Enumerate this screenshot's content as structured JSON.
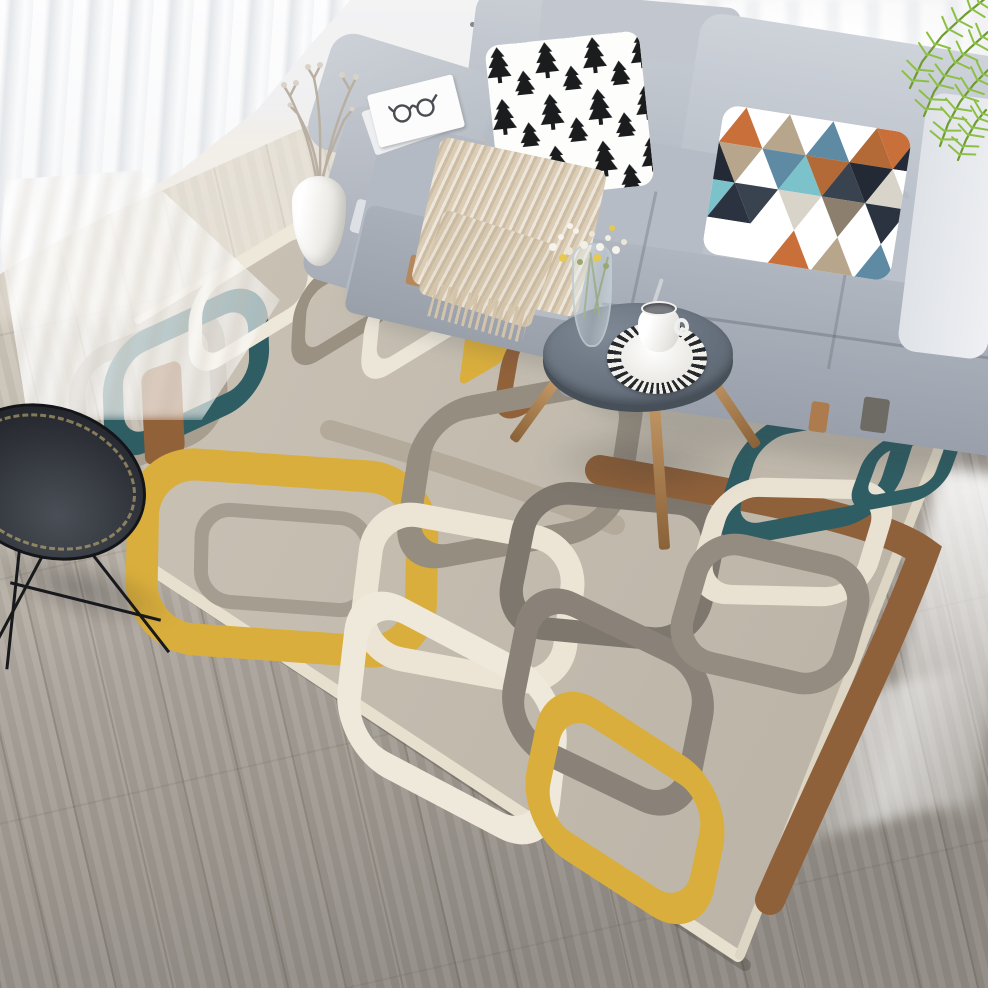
{
  "meta": {
    "title": "Scandinavian living room with geometric area rug",
    "description": "Photograph of a bright living room: gray sectional sofa with a black-and-white pine-tree pillow and a multicolor triangle pillow, beige knitted throw, white sheer curtain, gray wood plank floor, small round gray coffee table with a striped mat, white cup and glass flower vase, white jug with dried branches, black wire side table, green palm leaves, and a large geometric rug with interlocking squared loops in teal, mustard yellow, brown, gray and cream."
  },
  "palette": {
    "wall": "#ececed",
    "floor_light": "#d8d2c6",
    "floor_dark": "#8e8982",
    "sofa_light": "#ced3da",
    "sofa_mid": "#b6bcc5",
    "sofa_dark": "#9aa0ab",
    "rug_base": "#c6bfb2",
    "rug_teal": "#2e5d63",
    "rug_yellow": "#d9ae3c",
    "rug_brown": "#8f613a",
    "rug_cream": "#ece5d6",
    "blanket": "#dbccb5",
    "wood": "#b5875a",
    "table_top": "#66707c",
    "black": "#17191c",
    "palm": "#79a838",
    "twig": "#b4aa9d"
  },
  "wall": {
    "dots": [
      [
        500,
        10
      ],
      [
        515,
        24
      ],
      [
        531,
        10
      ],
      [
        547,
        26
      ],
      [
        563,
        13
      ],
      [
        579,
        28
      ],
      [
        594,
        8
      ],
      [
        508,
        40
      ],
      [
        537,
        44
      ],
      [
        566,
        46
      ],
      [
        588,
        42
      ],
      [
        524,
        58
      ],
      [
        552,
        60
      ],
      [
        470,
        22
      ]
    ]
  },
  "rug": {
    "base_fill_from": "#cdc6b9",
    "base_fill_to": "#b9b1a4",
    "quad": "135,318 1249,-345 740,960 150,563",
    "clip": "135,318 430,140 560,60 830,60 900,100 988,100 988,988 0,988 0,318",
    "edge_shadow": {
      "d": "M150,568 L745,965",
      "sw": 12,
      "c": "rgba(60,55,48,0.28)"
    },
    "elements": [
      {
        "type": "path",
        "d": "M153,570 L738,956",
        "sw": 12,
        "c": "#e8e0cf"
      },
      {
        "type": "path",
        "d": "M740,955 L948,425",
        "sw": 10,
        "c": "#ded6c4"
      },
      {
        "type": "path",
        "d": "M138,320 L430,142",
        "sw": 8,
        "c": "#ece5d5"
      },
      {
        "type": "ring",
        "cx": 148,
        "cy": 395,
        "w": 150,
        "h": 115,
        "sw": 18,
        "rx": 34,
        "c": "#a79e8f"
      },
      {
        "type": "ring",
        "cx": 186,
        "cy": 372,
        "w": 160,
        "h": 100,
        "sw": 22,
        "rx": 36,
        "c": "#2e5d63"
      },
      {
        "type": "ring",
        "cx": 255,
        "cy": 296,
        "w": 140,
        "h": 82,
        "sw": 16,
        "rx": 30,
        "c": "#eee8da"
      },
      {
        "type": "band",
        "cx": 163,
        "cy": 413,
        "w": 42,
        "h": 95,
        "rx": 10,
        "c": "#91613a"
      },
      {
        "type": "ring",
        "cx": 350,
        "cy": 298,
        "w": 120,
        "h": 74,
        "sw": 16,
        "rx": 26,
        "c": "#9a9183"
      },
      {
        "type": "ring",
        "cx": 424,
        "cy": 308,
        "w": 126,
        "h": 78,
        "sw": 18,
        "rx": 28,
        "c": "#ece6d8"
      },
      {
        "type": "band",
        "cx": 488,
        "cy": 328,
        "w": 54,
        "h": 92,
        "rx": 10,
        "c": "#d9ae3c"
      },
      {
        "type": "ring",
        "cx": 560,
        "cy": 348,
        "w": 120,
        "h": 86,
        "sw": 20,
        "rx": 30,
        "c": "#91613a"
      },
      {
        "type": "path",
        "d": "M540,238 C610,258 660,285 700,318",
        "sw": 24,
        "c": "#8f613a"
      },
      {
        "type": "ring",
        "cx": 282,
        "cy": 558,
        "w": 280,
        "h": 175,
        "sw": 32,
        "rx": 54,
        "c": "#d9ae3c"
      },
      {
        "type": "ring",
        "cx": 285,
        "cy": 560,
        "w": 168,
        "h": 92,
        "sw": 14,
        "rx": 30,
        "c": "#a59d90"
      },
      {
        "type": "path",
        "d": "M330,430 C430,458 530,492 615,525",
        "sw": 20,
        "c": "#b3aa9c"
      },
      {
        "type": "ring",
        "cx": 520,
        "cy": 470,
        "w": 215,
        "h": 150,
        "sw": 24,
        "rx": 44,
        "c": "#958d80"
      },
      {
        "type": "ring",
        "cx": 468,
        "cy": 598,
        "w": 205,
        "h": 145,
        "sw": 24,
        "rx": 44,
        "c": "#ece5d6"
      },
      {
        "type": "ring",
        "cx": 612,
        "cy": 566,
        "w": 190,
        "h": 138,
        "sw": 23,
        "rx": 42,
        "c": "#7e776e"
      },
      {
        "type": "ring",
        "cx": 452,
        "cy": 718,
        "w": 225,
        "h": 155,
        "sw": 26,
        "rx": 48,
        "c": "#efe9db"
      },
      {
        "type": "ring",
        "cx": 608,
        "cy": 702,
        "w": 195,
        "h": 150,
        "sw": 24,
        "rx": 44,
        "c": "#8a8278"
      },
      {
        "type": "ring",
        "cx": 625,
        "cy": 808,
        "w": 195,
        "h": 135,
        "sw": 28,
        "rx": 46,
        "c": "#d9ae3c"
      },
      {
        "type": "path",
        "d": "M600,470 C760,498 880,520 924,552 C892,640 822,780 770,900",
        "sw": 30,
        "c": "#8f613a"
      },
      {
        "type": "ring",
        "cx": 818,
        "cy": 470,
        "w": 165,
        "h": 115,
        "sw": 22,
        "rx": 38,
        "c": "#2e5d63"
      },
      {
        "type": "ring",
        "cx": 792,
        "cy": 542,
        "w": 165,
        "h": 112,
        "sw": 20,
        "rx": 36,
        "c": "#e9e2d3"
      },
      {
        "type": "ring",
        "cx": 770,
        "cy": 614,
        "w": 165,
        "h": 122,
        "sw": 22,
        "rx": 38,
        "c": "#948c80"
      },
      {
        "type": "ring",
        "cx": 906,
        "cy": 468,
        "w": 84,
        "h": 64,
        "sw": 16,
        "rx": 22,
        "c": "#2e5d63"
      }
    ]
  },
  "pillows": {
    "tree": {
      "bg": "#fdfdfc",
      "color": "#1a1c1e",
      "path": "M12,2 L19,12 L16,12 L22,22 L18,22 L24,32 L14,32 L14,38 L10,38 L10,32 L0,32 L6,22 L2,22 L8,12 L5,12 Z"
    },
    "triangle": {
      "bg": "#ffffff",
      "palette": [
        "#2b3340",
        "#ffffff",
        "#c96f3a",
        "#ffffff",
        "#7cc2cb",
        "#b8a68c",
        "#ffffff",
        "#39424f",
        "#5e8ba3",
        "#ffffff",
        "#d8d4ca",
        "#b46a36",
        "#ffffff",
        "#8c7f6d",
        "#232a35",
        "#ffffff"
      ]
    }
  },
  "palm": {
    "spine": "#6f9c31",
    "leaf": "#8cbf45",
    "fronds": [
      {
        "pts": [
          [
            108,
            6
          ],
          [
            88,
            22
          ],
          [
            64,
            44
          ],
          [
            44,
            70
          ],
          [
            32,
            96
          ]
        ]
      },
      {
        "pts": [
          [
            110,
            40
          ],
          [
            92,
            56
          ],
          [
            72,
            76
          ],
          [
            56,
            100
          ],
          [
            46,
            124
          ]
        ]
      },
      {
        "pts": [
          [
            110,
            78
          ],
          [
            96,
            92
          ],
          [
            82,
            110
          ],
          [
            70,
            132
          ],
          [
            62,
            154
          ]
        ]
      },
      {
        "pts": [
          [
            108,
            118
          ],
          [
            98,
            130
          ],
          [
            88,
            148
          ],
          [
            80,
            168
          ]
        ]
      }
    ]
  },
  "flowers": {
    "dots": [
      [
        553,
        247,
        4,
        "#f6f3ec"
      ],
      [
        561,
        237,
        3,
        "#f6f3ec"
      ],
      [
        569,
        251,
        4,
        "#eae6da"
      ],
      [
        576,
        231,
        3,
        "#f6f3ec"
      ],
      [
        584,
        245,
        4,
        "#f2efe6"
      ],
      [
        592,
        234,
        3,
        "#eae6da"
      ],
      [
        600,
        247,
        4,
        "#f6f3ec"
      ],
      [
        608,
        238,
        3,
        "#f2efe6"
      ],
      [
        616,
        250,
        4,
        "#f6f3ec"
      ],
      [
        624,
        242,
        3,
        "#eae6da"
      ],
      [
        563,
        258,
        4,
        "#e6c94e"
      ],
      [
        597,
        258,
        4,
        "#e6c94e"
      ],
      [
        612,
        228,
        3,
        "#e6c94e"
      ],
      [
        580,
        262,
        3,
        "#9aa86b"
      ],
      [
        606,
        266,
        3,
        "#9aa86b"
      ],
      [
        570,
        226,
        3,
        "#f6f3ec"
      ]
    ]
  }
}
